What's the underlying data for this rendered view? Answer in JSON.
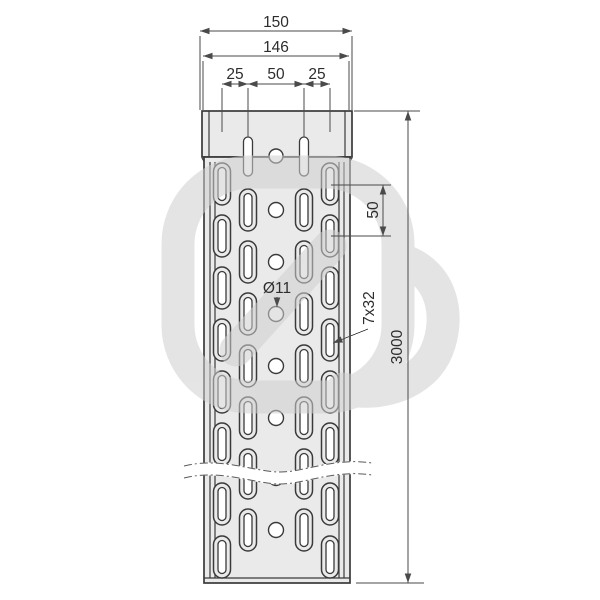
{
  "labels": {
    "overall_width": "150",
    "flange_width": "146",
    "edge_to_slot": "25",
    "slot_to_slot": "50",
    "slot_to_edge": "25",
    "row_spacing": "50",
    "tray_length": "3000",
    "hole_diameter": "Ø11",
    "slot_dimensions": "7x32"
  },
  "colors": {
    "background": "#ffffff",
    "tray_fill": "#eaeaea",
    "outline": "#3a3a3a",
    "dimension_lines": "#4a4a4a",
    "text": "#2d2d2d",
    "watermark": "#cfcfcf"
  }
}
